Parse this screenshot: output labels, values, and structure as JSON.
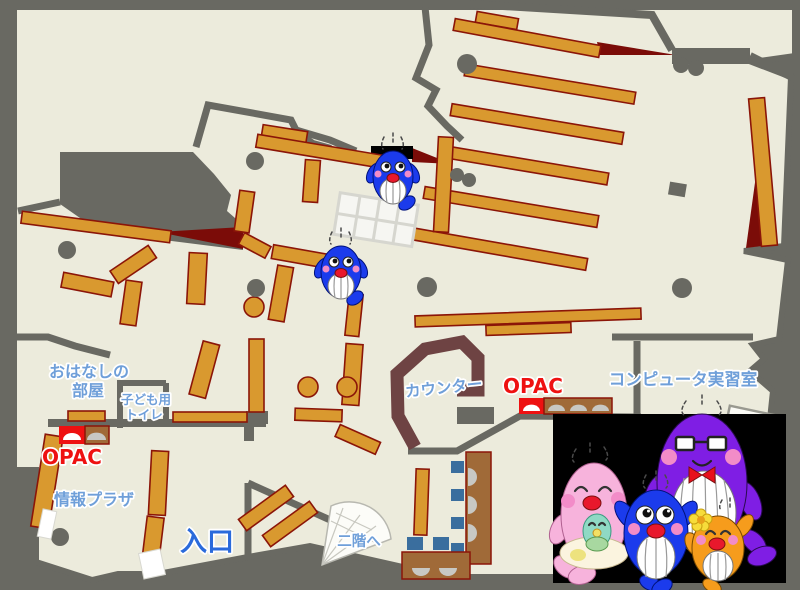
{
  "map": {
    "title": "library-first-floor-map",
    "rooms": {
      "storytelling": {
        "line1": "おはなしの",
        "line2": "部屋"
      },
      "kids_toilet": {
        "line1": "子ども用",
        "line2": "トイレ"
      },
      "info_plaza": {
        "label": "情報プラザ"
      },
      "entrance": {
        "label": "入口"
      },
      "stairs": {
        "label": "二階へ"
      },
      "counter": {
        "label": "カウンター"
      },
      "computer_room": {
        "label": "コンピュータ実習室"
      }
    },
    "opac_left": {
      "label": "OPAC"
    },
    "opac_right": {
      "label": "OPAC"
    },
    "colors": {
      "floor": "#ECEBDC",
      "wall_gray": "#696962",
      "shelf_orange": "#D9992F",
      "shelf_border": "#8B1508",
      "dark_red": "#7B0C08",
      "label_blue": "#6F9FD9",
      "entrance_blue": "#2A6ADB",
      "opac_red": "#EE1111",
      "counter_brown": "#6E4343",
      "desk_brown": "#A06A38",
      "chair_blue": "#3A6E9E",
      "panel_black": "#000000",
      "whale_blue": "#1B3BEC",
      "whale_pink": "#F7B3DC",
      "whale_purple": "#7F1EE4",
      "whale_orange": "#F69C1C",
      "whale_baby_teal": "#8FD9C4"
    },
    "characters": [
      {
        "name": "pink-whale-mother"
      },
      {
        "name": "baby-whale"
      },
      {
        "name": "blue-whale-child"
      },
      {
        "name": "purple-whale-father"
      },
      {
        "name": "orange-whale-child"
      },
      {
        "name": "map-whale-1"
      },
      {
        "name": "map-whale-2"
      }
    ]
  }
}
